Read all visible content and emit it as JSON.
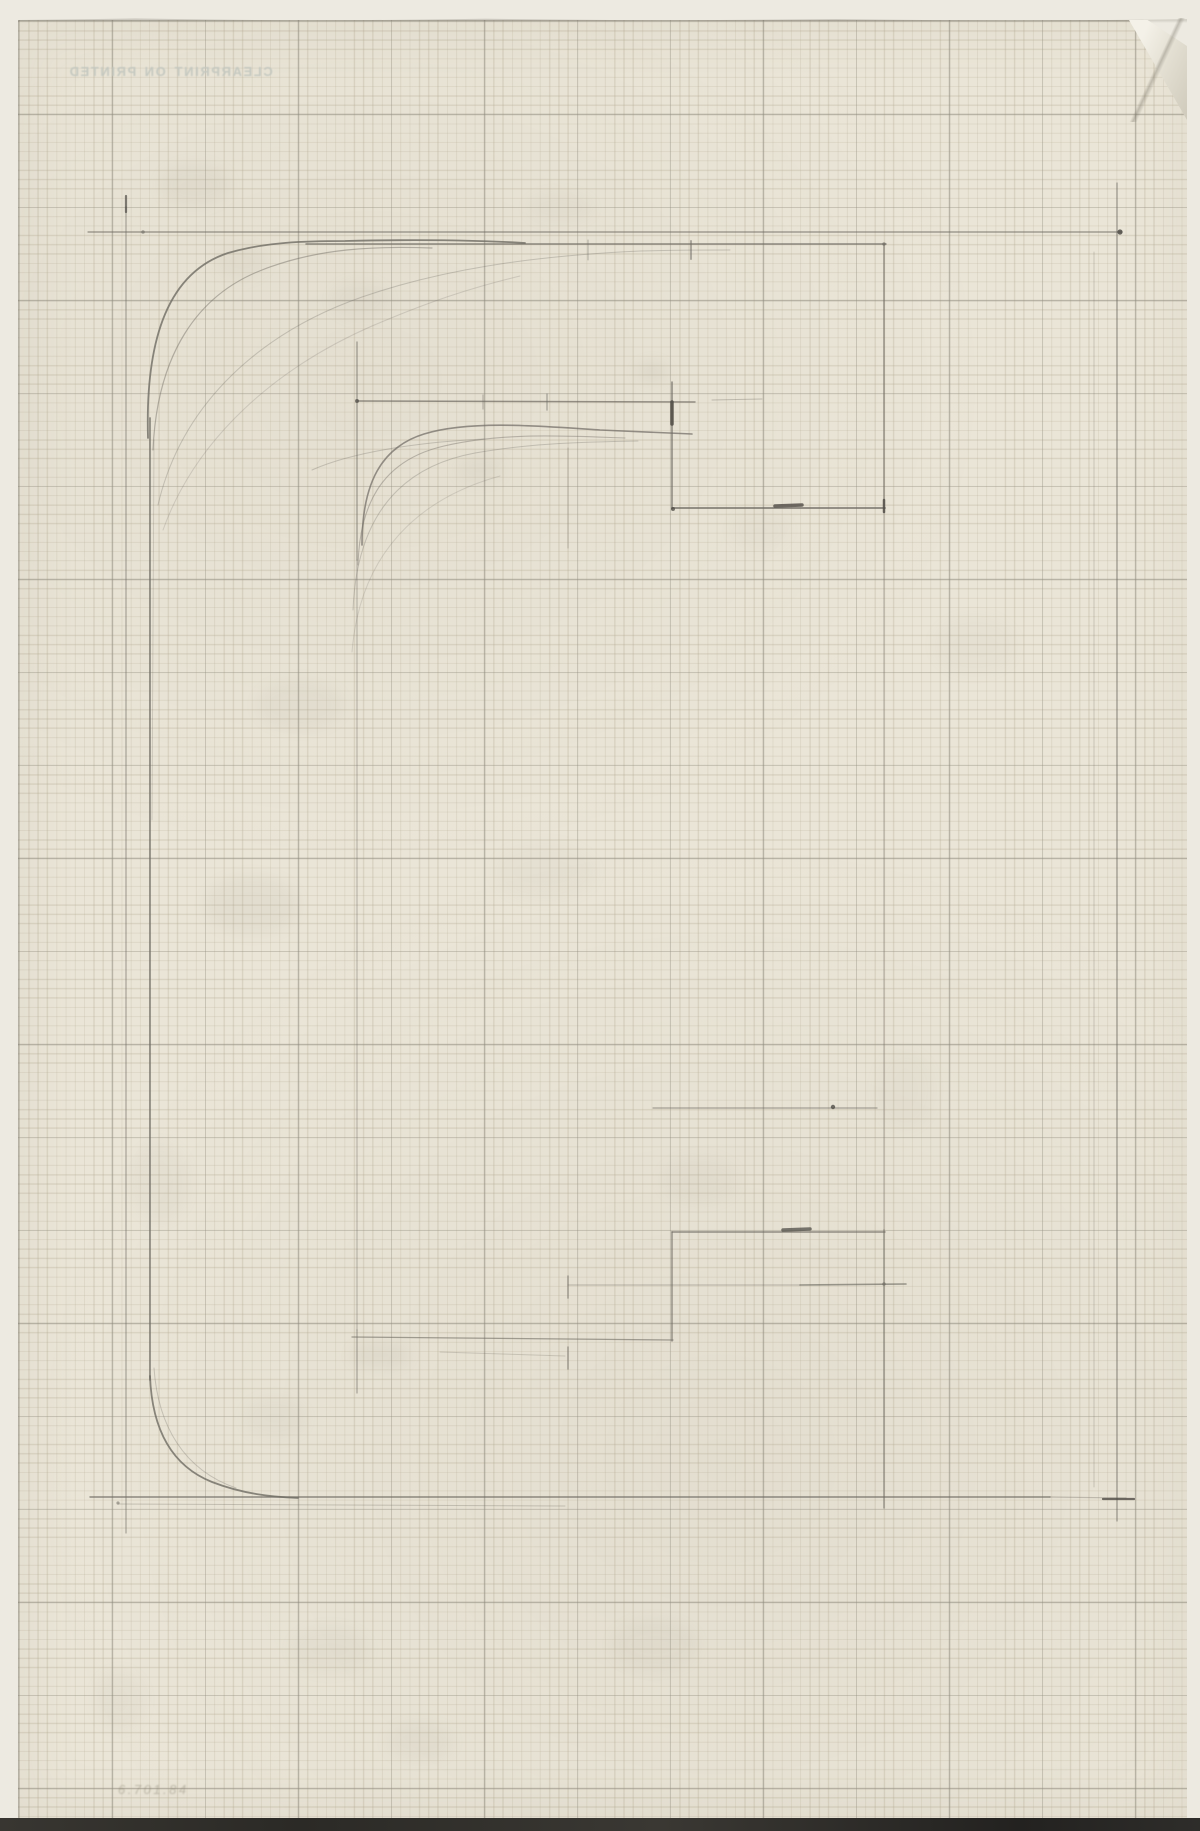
{
  "artwork": {
    "description": "pencil construction sketch of a rounded square C-form on printed graph paper",
    "watermark": "PRINTED ON CLEARPRINT",
    "inscription": "6.701.84",
    "colors": {
      "paper": "#eae5d7",
      "margin": "#edeae1",
      "grid_minor": "#b2a890",
      "grid_major": "#8a887e",
      "graphite": "#6e6a62",
      "graphite_dark": "#4f4c46",
      "smudge": "#8a8376",
      "watermark_ink": "#c4c8c0",
      "scan_band": "#2e2d2a"
    }
  },
  "drawing": {
    "lines": [
      [
        88,
        232,
        1122,
        232,
        1.2,
        0.7,
        0
      ],
      [
        126,
        207,
        126,
        1533,
        1.2,
        0.55,
        0
      ],
      [
        1117,
        183,
        1117,
        1521,
        1.2,
        0.65,
        0
      ],
      [
        90,
        1497,
        1050,
        1497,
        1.4,
        0.75,
        0
      ],
      [
        1050,
        1497,
        1126,
        1498,
        1.2,
        0.35,
        0
      ],
      [
        118,
        1504,
        565,
        1506,
        1.0,
        0.3,
        0
      ],
      [
        1103,
        1499,
        1134,
        1499,
        2.2,
        0.8,
        1
      ],
      [
        306,
        244,
        886,
        244,
        1.5,
        0.75,
        0
      ],
      [
        884,
        244,
        884,
        512,
        1.4,
        0.7,
        0
      ],
      [
        884,
        512,
        884,
        1230,
        1.1,
        0.4,
        0
      ],
      [
        884,
        1230,
        884,
        1508,
        1.4,
        0.65,
        0
      ],
      [
        150,
        418,
        150,
        1380,
        1.7,
        0.75,
        0
      ],
      [
        154,
        440,
        152,
        820,
        0.9,
        0.25,
        0
      ],
      [
        1094,
        252,
        1094,
        1487,
        1.0,
        0.28,
        0
      ],
      [
        357,
        401,
        695,
        402,
        1.4,
        0.7,
        0
      ],
      [
        712,
        400,
        762,
        399,
        1.0,
        0.35,
        0
      ],
      [
        357,
        342,
        357,
        560,
        1.3,
        0.6,
        0
      ],
      [
        357,
        560,
        357,
        1330,
        1.1,
        0.42,
        0
      ],
      [
        357,
        1330,
        357,
        1393,
        1.2,
        0.55,
        0
      ],
      [
        352,
        1337,
        673,
        1340,
        1.3,
        0.6,
        0
      ],
      [
        672,
        382,
        672,
        509,
        1.5,
        0.75,
        0
      ],
      [
        672,
        508,
        885,
        508,
        1.8,
        0.8,
        0
      ],
      [
        775,
        506,
        802,
        505,
        3.5,
        0.8,
        1
      ],
      [
        672,
        402,
        672,
        424,
        3.5,
        0.85,
        1
      ],
      [
        653,
        1108,
        877,
        1108,
        1.2,
        0.55,
        0
      ],
      [
        672,
        1232,
        672,
        1341,
        1.4,
        0.7,
        0
      ],
      [
        672,
        1232,
        885,
        1232,
        1.4,
        0.7,
        0
      ],
      [
        783,
        1230,
        810,
        1229,
        3.5,
        0.75,
        1
      ],
      [
        568,
        1285,
        800,
        1285,
        1.1,
        0.42,
        0
      ],
      [
        800,
        1285,
        906,
        1284,
        1.6,
        0.65,
        0
      ],
      [
        568,
        448,
        568,
        548,
        1.0,
        0.35,
        0
      ],
      [
        568,
        1276,
        568,
        1298,
        1.6,
        0.5,
        0
      ],
      [
        568,
        1347,
        568,
        1369,
        1.6,
        0.5,
        0
      ],
      [
        588,
        240,
        588,
        260,
        1.0,
        0.45,
        0
      ],
      [
        691,
        241,
        691,
        259,
        2.0,
        0.5,
        0
      ],
      [
        483,
        395,
        483,
        409,
        1.2,
        0.4,
        0
      ],
      [
        547,
        394,
        547,
        410,
        1.5,
        0.45,
        0
      ],
      [
        126,
        196,
        126,
        212,
        2.2,
        0.7,
        1
      ],
      [
        884,
        500,
        884,
        512,
        2.5,
        0.8,
        1
      ],
      [
        440,
        1352,
        565,
        1356,
        1.0,
        0.25,
        0
      ]
    ],
    "curves": [
      {
        "d": "M 148,438 C 145,335 170,272 228,253 C 266,242 305,241 345,241 C 430,239 490,241 525,243",
        "w": 1.8,
        "o": 0.8
      },
      {
        "d": "M 153,450 C 157,355 197,295 262,270 C 318,248 375,246 432,248",
        "w": 1.2,
        "o": 0.45
      },
      {
        "d": "M 158,505 C 182,402 262,332 362,297 C 440,270 530,256 640,251 C 680,250 710,250 730,250",
        "w": 1.0,
        "o": 0.3
      },
      {
        "d": "M 163,530 C 196,438 276,368 372,326 C 428,302 470,288 520,276",
        "w": 1.0,
        "o": 0.22
      },
      {
        "d": "M 362,545 C 362,482 382,447 424,434 C 470,420 540,426 600,430 C 640,432 668,433 692,434",
        "w": 1.6,
        "o": 0.7
      },
      {
        "d": "M 358,565 C 360,492 392,458 444,446 C 505,432 566,436 625,438",
        "w": 1.1,
        "o": 0.4
      },
      {
        "d": "M 353,610 C 357,512 404,466 475,453 C 532,443 584,442 638,441",
        "w": 1.0,
        "o": 0.3
      },
      {
        "d": "M 312,470 C 352,452 420,442 484,439",
        "w": 1.0,
        "o": 0.3
      },
      {
        "d": "M 352,652 C 360,552 420,498 500,476",
        "w": 1.0,
        "o": 0.2
      },
      {
        "d": "M 150,1376 C 152,1430 172,1466 212,1482 C 243,1494 272,1497 298,1498",
        "w": 1.8,
        "o": 0.8
      },
      {
        "d": "M 154,1368 C 158,1426 184,1470 236,1488",
        "w": 1.0,
        "o": 0.3
      }
    ],
    "dots": [
      [
        1120,
        232,
        2.6,
        0.85,
        1
      ],
      [
        833,
        1107,
        2.2,
        0.8,
        1
      ],
      [
        143,
        232,
        1.8,
        0.6,
        0
      ],
      [
        118,
        1503,
        1.6,
        0.55,
        0
      ],
      [
        357,
        401,
        2.0,
        0.7,
        1
      ],
      [
        884,
        1284,
        1.8,
        0.6,
        0
      ],
      [
        673,
        509,
        2.0,
        0.75,
        1
      ],
      [
        884,
        244,
        1.8,
        0.6,
        0
      ]
    ],
    "smudges": [
      [
        195,
        185,
        36,
        22,
        0.07
      ],
      [
        242,
        262,
        26,
        18,
        0.06
      ],
      [
        560,
        208,
        34,
        16,
        0.05
      ],
      [
        360,
        300,
        30,
        20,
        0.05
      ],
      [
        300,
        705,
        44,
        26,
        0.06
      ],
      [
        252,
        905,
        48,
        30,
        0.07
      ],
      [
        160,
        1182,
        30,
        40,
        0.05
      ],
      [
        700,
        1180,
        40,
        24,
        0.05
      ],
      [
        420,
        1742,
        34,
        20,
        0.06
      ],
      [
        655,
        1645,
        44,
        26,
        0.06
      ],
      [
        275,
        1418,
        32,
        22,
        0.05
      ],
      [
        545,
        872,
        52,
        30,
        0.04
      ],
      [
        975,
        645,
        42,
        30,
        0.04
      ],
      [
        760,
        530,
        30,
        20,
        0.04
      ],
      [
        330,
        1650,
        40,
        24,
        0.05
      ],
      [
        905,
        1090,
        30,
        40,
        0.04
      ],
      [
        120,
        1700,
        26,
        30,
        0.05
      ],
      [
        480,
        470,
        24,
        14,
        0.06
      ],
      [
        652,
        372,
        16,
        10,
        0.1
      ],
      [
        380,
        1355,
        30,
        14,
        0.08
      ]
    ]
  }
}
